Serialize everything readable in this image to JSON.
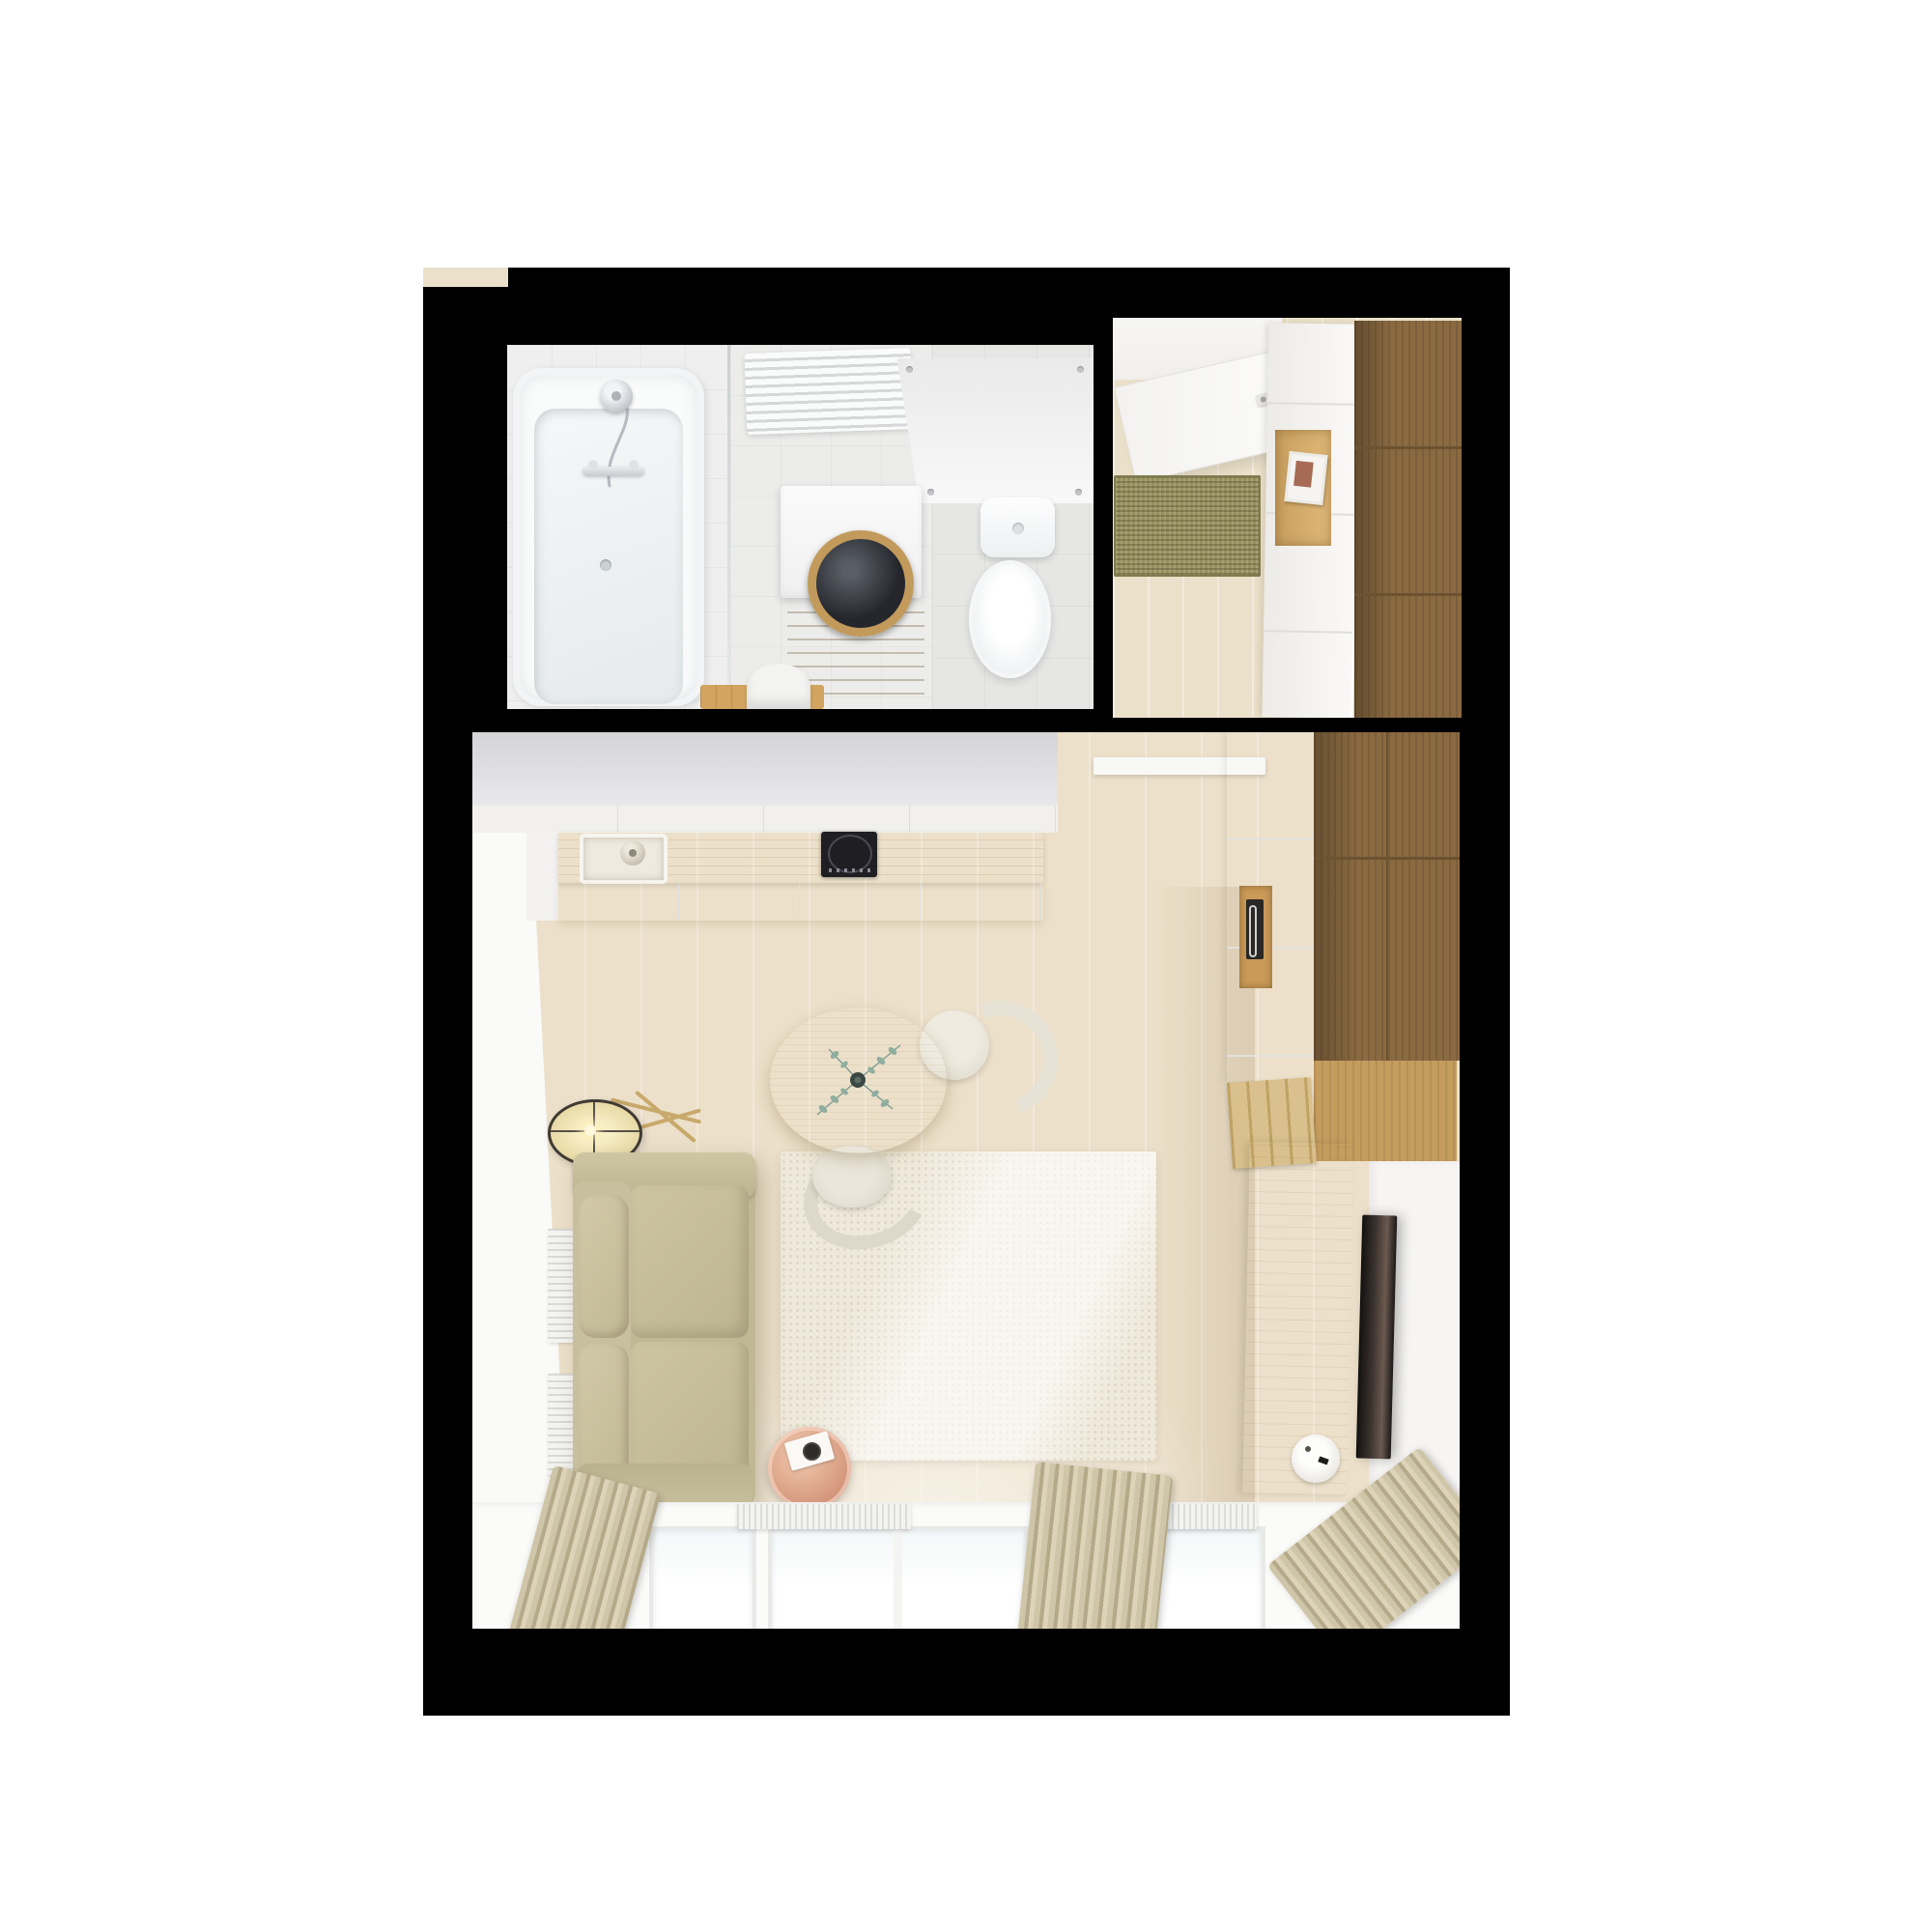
{
  "scene": {
    "title": "Top-down 3D render floor plan of a small studio apartment",
    "description": "Rendered plan with bathroom, entry hallway and combined living room / kitchen on a black wall mask over white background"
  },
  "palette": {
    "background": "#ffffff",
    "walls": "#000000",
    "floor_wood": "#ece0ca",
    "dark_wood_wardrobe": "#8a6a41",
    "counter_wood": "#ddbf85",
    "sofa_fabric": "#c6bd9c",
    "rug": "#efe9db",
    "doormat": "#97915f",
    "copper_table": "#d89d82",
    "cooktop": "#1e1e23",
    "plant_leaves": "#7e9d94"
  },
  "rooms": {
    "bathroom": {
      "label": "Bathroom",
      "bathtub": "Bathtub with shower",
      "shower_head": "Hand shower head",
      "faucet": "Bath mixer tap",
      "glass_screen": "Glass shower screen",
      "towel_radiator": "Towel radiator",
      "washing_machine": "Washing machine",
      "washer_door": "Washing machine door",
      "wood_mat": "Wooden bath mat",
      "wall_panel": "Wall panel",
      "toilet": "Toilet",
      "toilet_tank": "Toilet cistern",
      "stool": "Stool with wooden shelf"
    },
    "hallway": {
      "label": "Entry hallway",
      "entry_door": "Entry door",
      "door_handle": "Door handle",
      "doormat": "Doormat",
      "sideboard": "Shoe cabinet",
      "shelf_niche": "Open shelf niche",
      "picture_frame": "Small picture frame",
      "wardrobe": "Hallway wardrobe"
    },
    "living": {
      "label": "Living room with kitchenette",
      "top_wall": "Kitchen wall with upper cabinets",
      "counter": "Kitchen counter",
      "sink": "Kitchen sink",
      "faucet": "Kitchen tap",
      "cooktop": "Induction cooktop",
      "cabinets": "Kitchen base cabinets",
      "tall_unit": "Tall kitchen unit",
      "oven": "Built-in oven",
      "shelf": "Wall shelf",
      "wardrobe": "Wardrobe",
      "wardrobe_lower": "Wardrobe lower section",
      "pigeonholes": "Open divider shelf",
      "tv_console": "TV sideboard",
      "tv": "Wall-mounted TV",
      "speaker": "Speaker on sideboard",
      "sofa": "Two-seat sofa",
      "floor_lamp": "Floor lamp",
      "dining_table": "Round dining table",
      "plant": "Eucalyptus in vase",
      "chair_top": "Dining chair",
      "chair_bottom": "Dining chair",
      "rug": "Cream area rug",
      "side_table": "Copper side table",
      "notebook": "Notebook",
      "cup": "Cup",
      "radiator": "Radiator under window",
      "wall_radiators": "Wall radiator panel",
      "window": "Window",
      "curtain": "Curtain",
      "passage": "Passage to hallway"
    }
  }
}
